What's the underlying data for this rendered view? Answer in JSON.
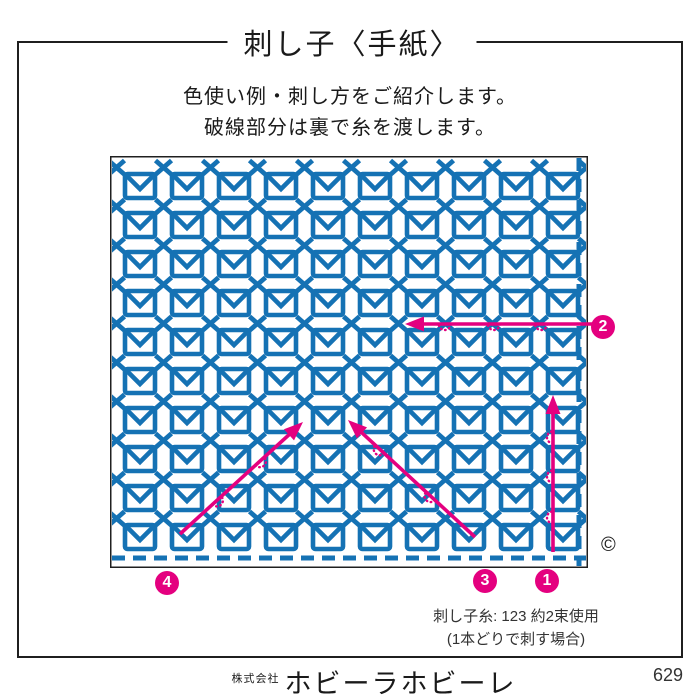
{
  "page": {
    "title": "刺し子〈手紙〉",
    "intro_line1": "色使い例・刺し方をご紹介します。",
    "intro_line2": "破線部分は裏で糸を渡します。",
    "copyright_symbol": "©",
    "thread_note_line1": "刺し子糸: 123 約2束使用",
    "thread_note_line2": "(1本どりで刺す場合)",
    "footer_company_prefix": "株式会社",
    "footer_company_name": "ホビーラホビーレ",
    "page_number": "629"
  },
  "colors": {
    "stitch_blue": "#1572b4",
    "arrow_pink": "#e4007f",
    "frame_black": "#1f1f1f"
  },
  "diagram": {
    "x": 110,
    "y": 156,
    "width": 478,
    "height": 412,
    "motif_grid": {
      "icon": "envelope-icon",
      "cols": 10,
      "rows": 10,
      "x0": 30,
      "y0": 30,
      "dx": 47,
      "dy": 39,
      "motif_w": 30,
      "motif_h": 24
    },
    "cross_grid": {
      "icon": "cross-stitch-icon",
      "cols": 10,
      "rows": 10,
      "x0": 6.5,
      "y0": 11.5,
      "dx": 47,
      "dy": 39,
      "size": 16
    },
    "dashed_edge_right_x": 469,
    "dashed_edge_bottom_y": 402,
    "arrows": [
      {
        "label": "1",
        "from": [
          443,
          396
        ],
        "to": [
          443,
          239
        ],
        "arc_fracs": [
          0.22,
          0.48,
          0.73
        ],
        "side": 1
      },
      {
        "label": "2",
        "from": [
          484,
          168
        ],
        "to": [
          295,
          168
        ],
        "arc_fracs": [
          0.28,
          0.53,
          0.79
        ],
        "side": 1
      },
      {
        "label": "3",
        "from": [
          365,
          381
        ],
        "to": [
          238,
          264
        ],
        "arc_fracs": [
          0.35,
          0.75
        ],
        "side": 1
      },
      {
        "label": "4",
        "from": [
          70,
          378
        ],
        "to": [
          193,
          266
        ],
        "arc_fracs": [
          0.3,
          0.65
        ],
        "side": -1
      }
    ],
    "step_markers": [
      {
        "label": "1",
        "x": 547,
        "y": 581
      },
      {
        "label": "2",
        "x": 603,
        "y": 327
      },
      {
        "label": "3",
        "x": 485,
        "y": 581
      },
      {
        "label": "4",
        "x": 167,
        "y": 583
      }
    ]
  }
}
